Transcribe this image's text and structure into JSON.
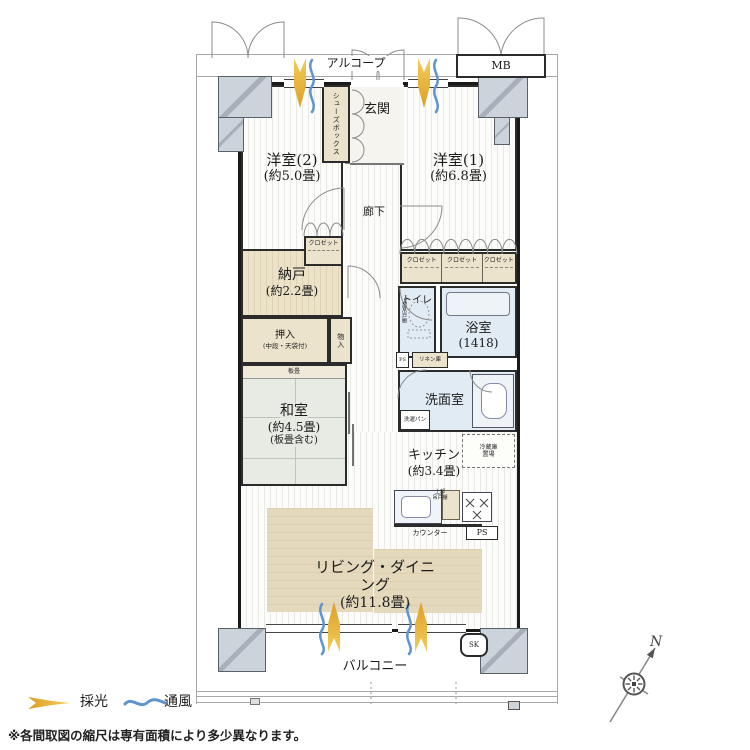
{
  "labels": {
    "alcove": "アルコープ",
    "mb": "MB",
    "entrance": "玄関",
    "shoes_box": "シューズボックス",
    "hallway": "廊下",
    "western2_name": "洋室(2)",
    "western2_size": "(約5.0畳)",
    "western1_name": "洋室(1)",
    "western1_size": "(約6.8畳)",
    "closet": "クロゼット",
    "storage_name": "納戸",
    "storage_size": "(約2.2畳)",
    "toilet": "トイレ",
    "toilet_upper_cabinet": "上部吊戸棚",
    "bath_name": "浴室",
    "bath_size": "(1418)",
    "ps": "PS",
    "linen": "リネン庫",
    "oshiire_name": "押入",
    "oshiire_note": "(中段・天袋付)",
    "monoire": "物入",
    "itadatami": "板畳",
    "washitsu_name": "和室",
    "washitsu_size": "(約4.5畳)",
    "washitsu_note": "(板畳含む)",
    "washroom": "洗面室",
    "washer_pan": "洗濯パン",
    "kitchen_name": "キッチン",
    "kitchen_size": "(約3.4畳)",
    "fridge_line1": "冷蔵庫",
    "fridge_line2": "置場",
    "upper_cabinet_line1": "上部",
    "upper_cabinet_line2": "吊戸棚",
    "counter": "カウンター",
    "living_name": "リビング・ダイニング",
    "living_size": "(約11.8畳)",
    "balcony": "バルコニー",
    "sk": "SK"
  },
  "legend": {
    "daylight": "採光",
    "ventilation": "通風"
  },
  "note": "※各間取図の縮尺は専有面積により多少異なります。",
  "compass": {
    "north": "N"
  },
  "colors": {
    "wall": "#1a1a1a",
    "pillar": "#ccd3da",
    "closet_beige": "#ece3cd",
    "wet_area_blue": "#e1ebf4",
    "tatami_green": "#e7ebe4",
    "rug_beige": "#e2d6bb",
    "daylight_icon": "#e4a92f",
    "ventilation_icon": "#5f94cf"
  }
}
